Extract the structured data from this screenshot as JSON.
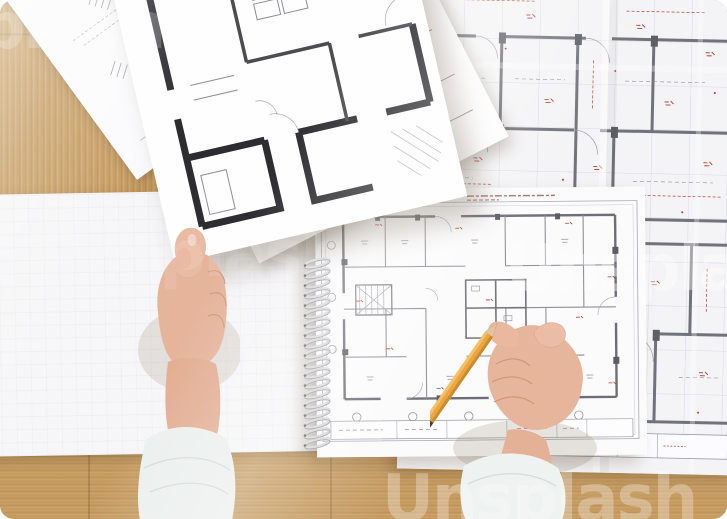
{
  "meta": {
    "alt": "Top-down photo of an architect's hands holding floor plan drawings and a pencil over a wooden desk"
  },
  "watermark": {
    "text": "Unsplash"
  },
  "palette": {
    "wood": "#c59b62",
    "wood_shadow": "#a8804d",
    "paper": "#f7f7f9",
    "bold_wall": "#2d2d31",
    "light_wall": "#6e6e76",
    "annotation_red": "#b23a2c",
    "grid_gray": "#d9d9e0",
    "pencil_body": "#eaa63e",
    "pencil_band": "#6e2a24",
    "sleeve": "#ecf0ee",
    "skin": "#e6b49b"
  },
  "objects": {
    "wooden_desk": "wooden desk surface",
    "blueprint": "large technical floor plan with red dimension marks",
    "notebook_plan": "spiral sketchpad page with floor plan",
    "album_left_page": "blank sketchpad page",
    "sketch_plan": "light site-sketch sheet",
    "under_plan": "bold floor plan sheet",
    "held_plan": "bold floor plan sheet held in hand",
    "spiral": "spiral binding",
    "left_hand": "left hand holding sheet",
    "right_hand": "right hand holding pencil",
    "pencil": "yellow graphite pencil"
  }
}
